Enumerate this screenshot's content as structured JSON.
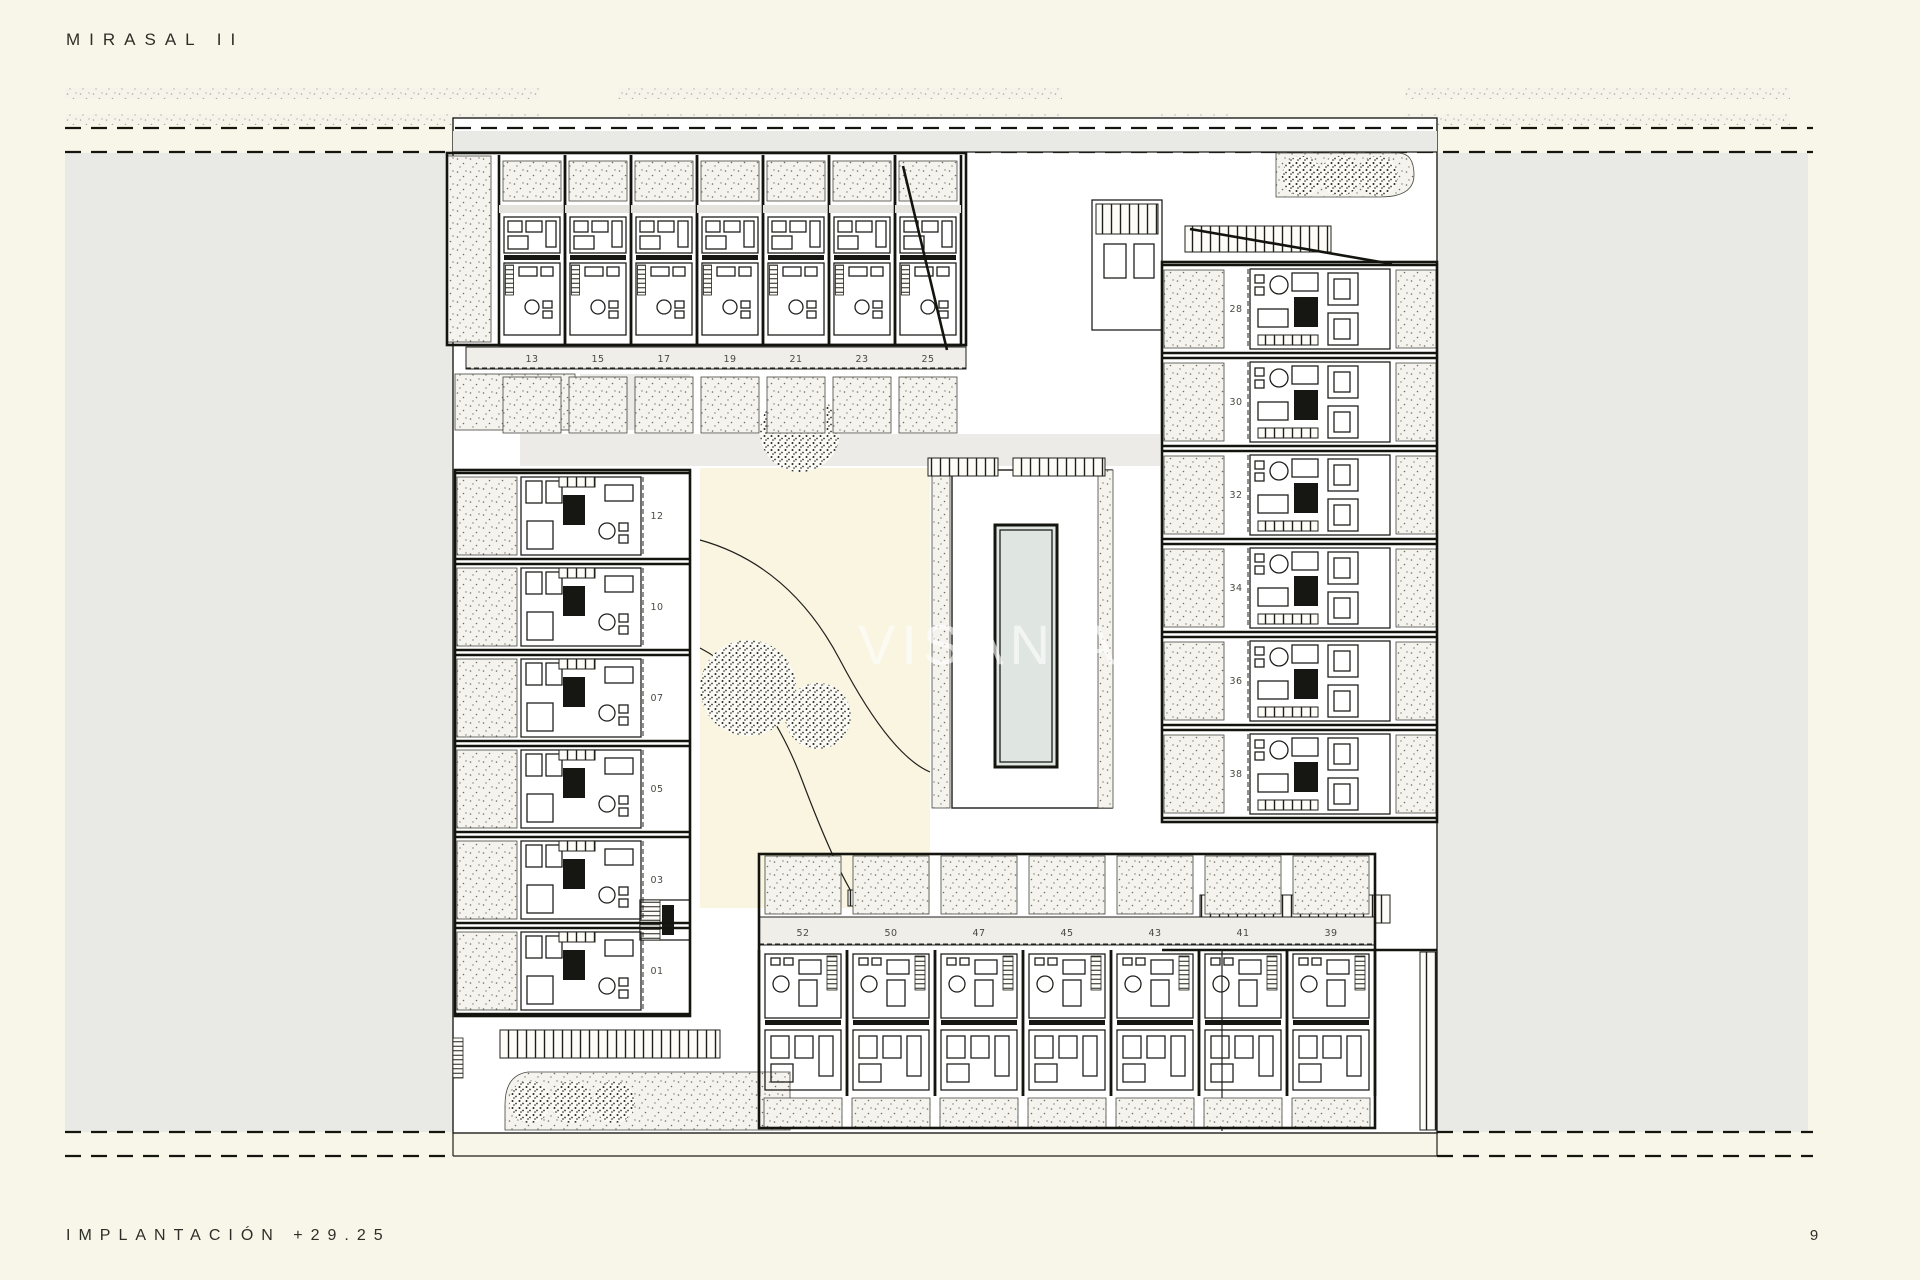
{
  "page": {
    "title": "MIRASAL II",
    "footer_label": "IMPLANTACIÓN +29.25",
    "page_number": "9",
    "watermark": "VISANIA"
  },
  "plan": {
    "top_row_units": [
      "13",
      "15",
      "17",
      "19",
      "21",
      "23",
      "25"
    ],
    "left_column_units": [
      "12",
      "10",
      "07",
      "05",
      "03",
      "01"
    ],
    "right_column_units": [
      "28",
      "30",
      "32",
      "34",
      "36",
      "38"
    ],
    "bottom_row_units": [
      "52",
      "50",
      "47",
      "45",
      "43",
      "41",
      "39"
    ]
  },
  "colors": {
    "background": "#f8f6e8",
    "side_panels": "#e9e9e6",
    "ink": "#1f1f1c",
    "courtyard": "#f9f5e1",
    "pool": "#dfe5e1",
    "number_band": "#efeee9",
    "watermark": "#ffffff"
  }
}
